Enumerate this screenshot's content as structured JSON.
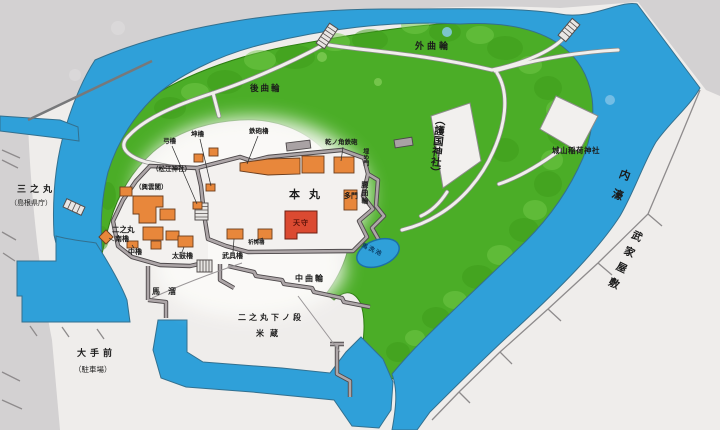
{
  "map": {
    "type": "castle-grounds-guide-map",
    "labels": {
      "sotokuruwa": "外曲輪",
      "ushirokuruwa": "後曲輪",
      "gokoku_jinja": "（護国神社）",
      "jozan_inari_jinja": "城山稲荷神社",
      "uchibori": "内濠",
      "buke_yashiki": "武家屋敷",
      "sannomaru": "三之丸",
      "sannomaru_sub": "（島根県庁）",
      "honmaru": "本丸",
      "tamon": "多門",
      "tenshu": "天守",
      "yumi_yagura": "弓櫓",
      "hitsujisaru_yagura": "坤櫓",
      "teppo_yagura": "鉄砲櫓",
      "inui_no_kado_teppo": "乾ノ角鉄砲",
      "matsue_jinja": "（松江神社）",
      "kounkaku": "（興雲閣）",
      "ninomaru": "二之丸",
      "minami_yagura": "南櫓",
      "naka_yagura": "中櫓",
      "taiko_yagura": "太鼓櫓",
      "bugu_yagura": "武具櫓",
      "kito_yagura": "祈祷櫓",
      "uzume_mon": "埋め門",
      "koshikuruwa": "腰曲輪",
      "uma_arai_ike": "馬洗池",
      "umadamari": "馬溜",
      "nakakuruwa": "中曲輪",
      "ninomaru_shita_no_dan": "二之丸下ノ段",
      "komegura": "米蔵",
      "otemae": "大手前",
      "otemae_sub": "（駐車場）"
    },
    "colors": {
      "water_blue": "#2fa0d9",
      "grounds_green": "#4bad27",
      "building_orange": "#e8873b",
      "keep_red": "#db4a31",
      "wall_gray": "#ada6a8",
      "board_gray": "#d3d1d2",
      "map_white": "#efedeb",
      "text": "#1b1b1b"
    }
  }
}
